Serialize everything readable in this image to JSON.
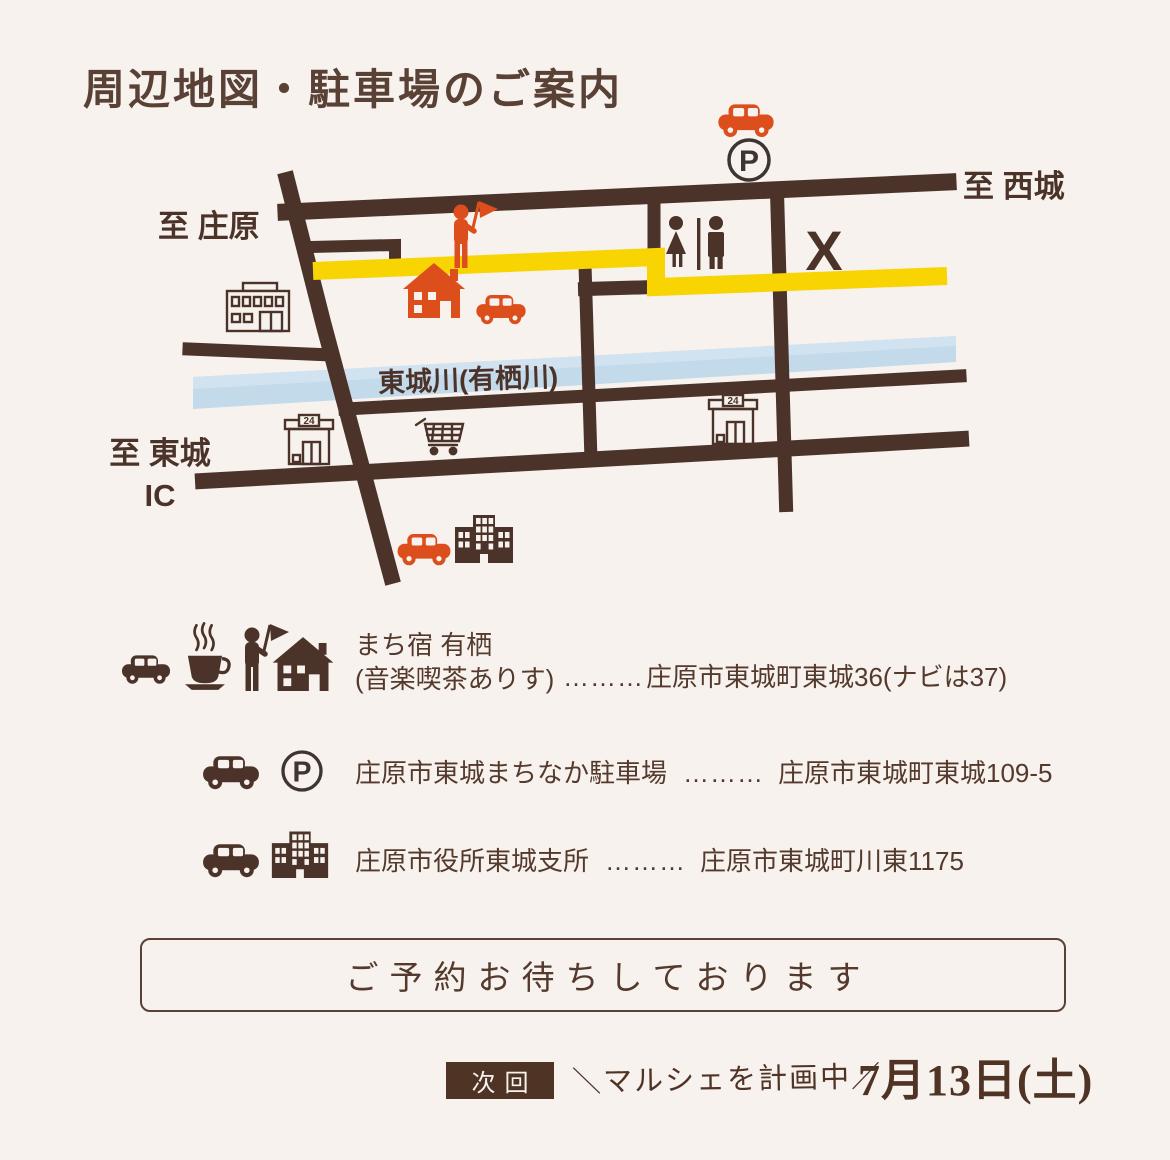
{
  "title": "周辺地図・駐車場のご案内",
  "colors": {
    "background": "#f7f2ed",
    "road_brown": "#4b332a",
    "text_brown": "#54392d",
    "accent_orange": "#dc4e1b",
    "route_yellow": "#f8d403",
    "river_blue": "#c2daea",
    "badge_bg": "#4f3425"
  },
  "map": {
    "labels": {
      "to_saijo": "至 西城",
      "to_shobara": "至 庄原",
      "river": "東城川(有栖川)",
      "to_tojo": "至 東城\nIC",
      "closed_mark": "X",
      "parking_letter": "P",
      "store_sign": "24"
    }
  },
  "legend": {
    "rows": [
      {
        "name_line1": "まち宿 有栖",
        "name_line2": "(音楽喫茶ありす)",
        "dots": "………",
        "address": "庄原市東城町東城36(ナビは37)"
      },
      {
        "name": "庄原市東城まちなか駐車場",
        "dots": "………",
        "address": "庄原市東城町東城109-5"
      },
      {
        "name": "庄原市役所東城支所",
        "dots": "………",
        "address": "庄原市東城町川東1175"
      }
    ]
  },
  "reservation_box": {
    "text": "ご予約お待ちしております"
  },
  "footer": {
    "next_badge": "次回",
    "announcement": "＼マルシェを計画中／",
    "date": "7月13日(土)"
  }
}
